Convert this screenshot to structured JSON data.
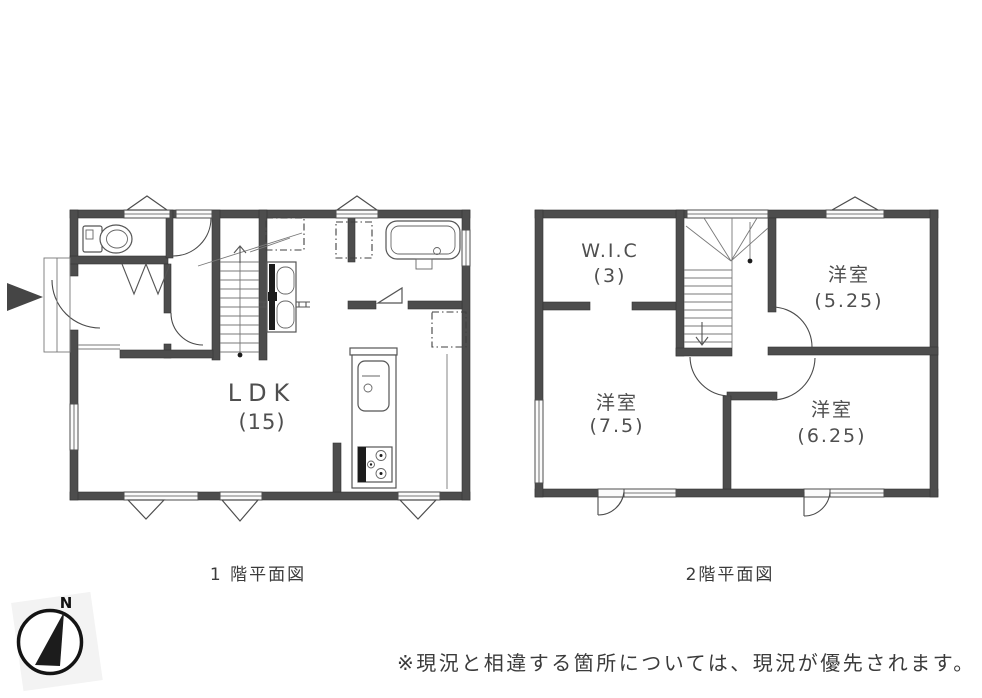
{
  "floor1": {
    "caption": "1 階平面図",
    "rooms": [
      {
        "name": "LDK",
        "size": "(15)"
      }
    ]
  },
  "floor2": {
    "caption": "2階平面図",
    "rooms": [
      {
        "name": "W.I.C",
        "size": "(3)"
      },
      {
        "name": "洋室",
        "size": "(5.25)"
      },
      {
        "name": "洋室",
        "size": "(7.5)"
      },
      {
        "name": "洋室",
        "size": "(6.25)"
      }
    ]
  },
  "compass": {
    "north_label": "N"
  },
  "footnote": "※現況と相違する箇所については、現況が優先されます。",
  "colors": {
    "wall": "#4d4d4d",
    "line": "#5a5a5a",
    "text": "#4f4f4f",
    "window_fill": "#fbfbfb",
    "needle_black": "#1c1c1c"
  }
}
